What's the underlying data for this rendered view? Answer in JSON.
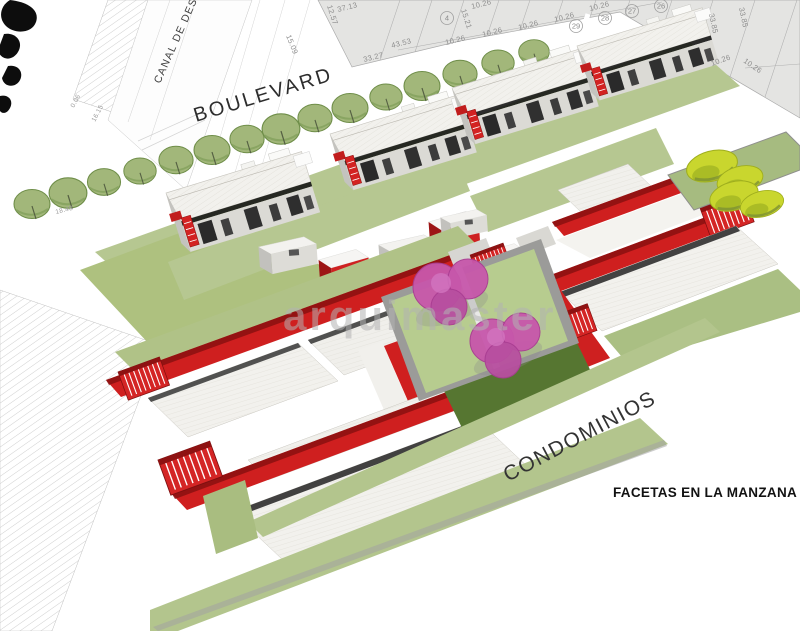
{
  "labels": {
    "boulevard": "BOULEVARD",
    "canal": "CANAL DE DESAGÜE",
    "condominios": "CONDOMINIOS",
    "caption": "FACETAS EN LA MANZANA",
    "watermark": "arquimaster"
  },
  "cadastre": {
    "lot_numbers": [
      {
        "value": "4",
        "x": 447,
        "y": 18
      },
      {
        "value": "26",
        "x": 661,
        "y": 6
      },
      {
        "value": "27",
        "x": 632,
        "y": 11
      },
      {
        "value": "28",
        "x": 605,
        "y": 18
      },
      {
        "value": "29",
        "x": 576,
        "y": 26
      }
    ],
    "dimensions": [
      {
        "value": "37.13",
        "x": 338,
        "y": 12,
        "rot": -14
      },
      {
        "value": "12.57",
        "x": 327,
        "y": 6,
        "rot": 72
      },
      {
        "value": "15.21",
        "x": 461,
        "y": 10,
        "rot": 72
      },
      {
        "value": "15.09",
        "x": 286,
        "y": 36,
        "rot": 68
      },
      {
        "value": "43.53",
        "x": 392,
        "y": 48,
        "rot": -14
      },
      {
        "value": "33.27",
        "x": 364,
        "y": 62,
        "rot": -14
      },
      {
        "value": "10.26",
        "x": 446,
        "y": 45,
        "rot": -14
      },
      {
        "value": "10.26",
        "x": 483,
        "y": 37,
        "rot": -14
      },
      {
        "value": "10.26",
        "x": 519,
        "y": 30,
        "rot": -14
      },
      {
        "value": "10.26",
        "x": 555,
        "y": 22,
        "rot": -14
      },
      {
        "value": "10.26",
        "x": 472,
        "y": 9,
        "rot": -14
      },
      {
        "value": "10.26",
        "x": 590,
        "y": 11,
        "rot": -14
      },
      {
        "value": "10.26",
        "x": 712,
        "y": 66,
        "rot": -20
      },
      {
        "value": "10.26",
        "x": 743,
        "y": 62,
        "rot": 35
      },
      {
        "value": "33.85",
        "x": 709,
        "y": 14,
        "rot": 78
      },
      {
        "value": "33.85",
        "x": 739,
        "y": 8,
        "rot": 78
      }
    ],
    "edge_dimensions": [
      {
        "value": "0.06",
        "x": 74,
        "y": 108,
        "rot": -62
      },
      {
        "value": "16.15",
        "x": 95,
        "y": 122,
        "rot": -62
      },
      {
        "value": "18.48",
        "x": 56,
        "y": 214,
        "rot": -14
      }
    ]
  },
  "colors": {
    "accent_red": "#ce2020",
    "accent_red_dark": "#8a1010",
    "lawn_light": "#b5c78f",
    "lawn_mid": "#aabf83",
    "lawn_dark": "#567631",
    "tree_green": "#a2b77a",
    "tree_chartreuse": "#c9d62e",
    "canopy_pink": "#c757ab",
    "cadastre_gray": "#e4e4e2",
    "roof_white": "#f2f1ed"
  }
}
